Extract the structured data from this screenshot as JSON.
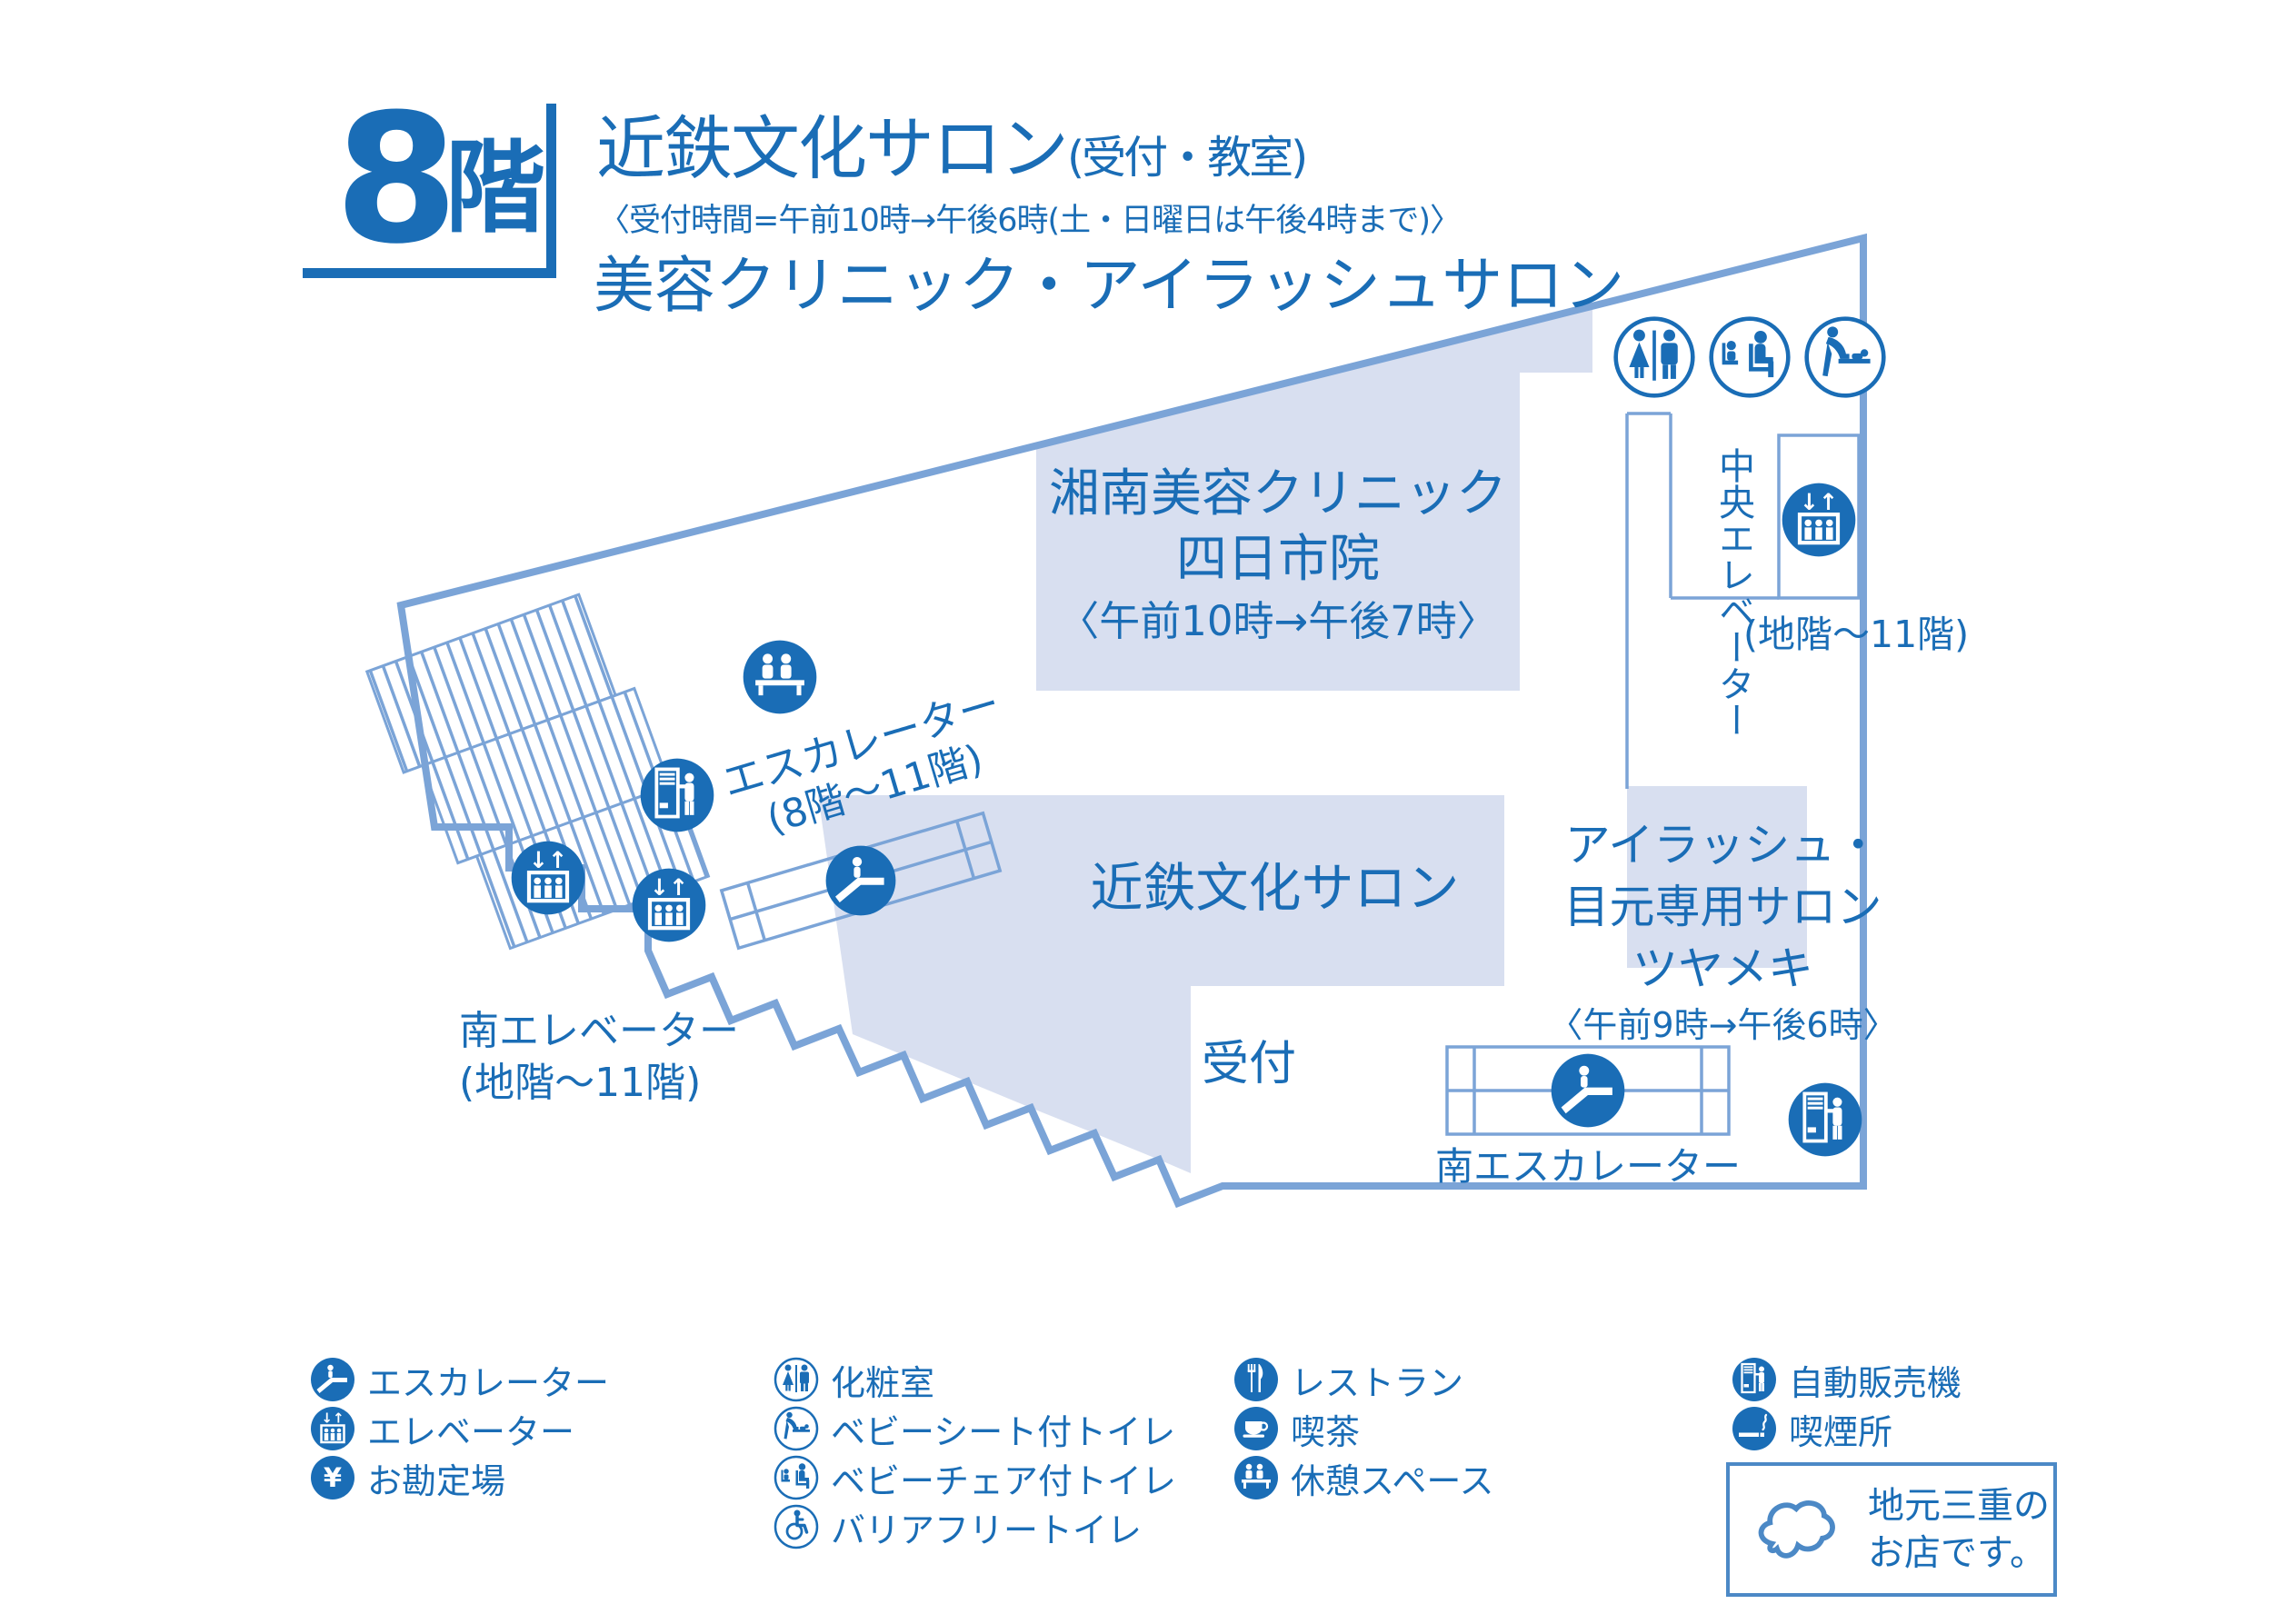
{
  "floor": {
    "number": "8",
    "unit": "階"
  },
  "header": {
    "title": "近鉄文化サロン",
    "title_note": "(受付・教室)",
    "reception_hours": "〈受付時間=午前10時→午後6時(土・日曜日は午後4時まで)〉",
    "subtitle": "美容クリニック・アイラッシュサロン"
  },
  "map": {
    "shonan_clinic": {
      "name_line1": "湘南美容クリニック",
      "name_line2": "四日市院",
      "hours": "〈午前10時→午後7時〉"
    },
    "culture_salon": "近鉄文化サロン",
    "eyelash_salon": {
      "line1": "アイラッシュ・",
      "line2": "目元専用サロン",
      "line3": "ツヤメキ",
      "hours": "〈午前9時→午後6時〉"
    },
    "reception": "受付",
    "nw_escalator": {
      "line1": "エスカレーター",
      "line2": "(8階〜11階)"
    },
    "south_elevator": {
      "line1": "南エレベーター",
      "line2": "(地階〜11階)"
    },
    "central_elevator": {
      "name": "中央エレベーター",
      "floors": "(地階〜11階)"
    },
    "south_escalator": "南エスカレーター"
  },
  "legend": {
    "col1": [
      {
        "icon": "escalator-icon",
        "label": "エスカレーター"
      },
      {
        "icon": "elevator-icon",
        "label": "エレベーター"
      },
      {
        "icon": "cashier-icon",
        "label": "お勘定場"
      }
    ],
    "col2": [
      {
        "icon": "restroom-icon",
        "label": "化粧室"
      },
      {
        "icon": "baby-sheet-toilet-icon",
        "label": "ベビーシート付トイレ"
      },
      {
        "icon": "baby-chair-toilet-icon",
        "label": "ベビーチェア付トイレ"
      },
      {
        "icon": "barrier-free-toilet-icon",
        "label": "バリアフリートイレ"
      }
    ],
    "col3": [
      {
        "icon": "restaurant-icon",
        "label": "レストラン"
      },
      {
        "icon": "cafe-icon",
        "label": "喫茶"
      },
      {
        "icon": "rest-space-icon",
        "label": "休憩スペース"
      }
    ],
    "col4": [
      {
        "icon": "vending-machine-icon",
        "label": "自動販売機"
      },
      {
        "icon": "smoking-area-icon",
        "label": "喫煙所"
      }
    ],
    "mie_box": {
      "line1": "地元三重の",
      "line2": "お店です。"
    }
  },
  "icons": {
    "elevator_arrows": "↓↑",
    "yen": "¥"
  },
  "colors": {
    "primary_blue": "#1a6db6",
    "wall_blue": "#7ba4d7",
    "area_lavender": "#d8dff0"
  }
}
